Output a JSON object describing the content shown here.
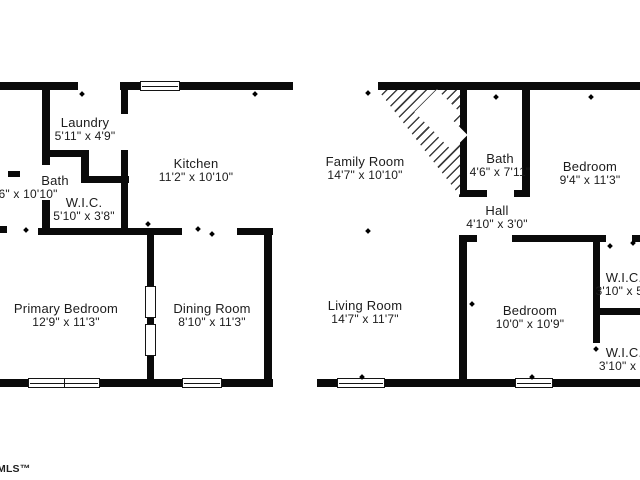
{
  "title": "Floor plan",
  "watermark": "MLS™",
  "colors": {
    "wall": "#0a0a0a",
    "text": "#1c1c1c",
    "background": "#ffffff"
  },
  "rooms": [
    {
      "name": "Laundry",
      "dims": "5'11\" x 4'9\""
    },
    {
      "name": "Kitchen",
      "dims": "11'2\" x 10'10\""
    },
    {
      "name": "Bath",
      "dims": "'6\" x 10'10\""
    },
    {
      "name": "W.I.C.",
      "dims": "5'10\" x 3'8\""
    },
    {
      "name": "Family Room",
      "dims": "14'7\" x 10'10\""
    },
    {
      "name": "Bath",
      "dims": "4'6\" x 7'11\""
    },
    {
      "name": "Bedroom",
      "dims": "9'4\" x 11'3\""
    },
    {
      "name": "Hall",
      "dims": "4'10\" x 3'0\""
    },
    {
      "name": "Primary Bedroom",
      "dims": "12'9\" x 11'3\""
    },
    {
      "name": "Dining Room",
      "dims": "8'10\" x 11'3\""
    },
    {
      "name": "Living Room",
      "dims": "14'7\" x 11'7\""
    },
    {
      "name": "Bedroom",
      "dims": "10'0\" x 10'9\""
    },
    {
      "name": "W.I.C.",
      "dims": "3'10\" x 5'1"
    },
    {
      "name": "W.I.C.",
      "dims": "3'10\" x 4'"
    }
  ]
}
